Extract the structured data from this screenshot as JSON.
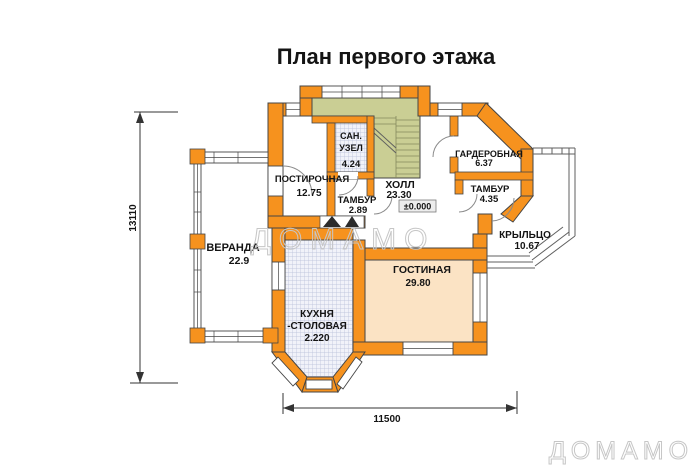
{
  "title": "План первого этажа",
  "watermark": {
    "text": "ДОМАМО"
  },
  "rooms": {
    "postirochnaya": {
      "name": "ПОСТИРОЧНАЯ",
      "area": "12.75"
    },
    "san_uzel": {
      "name_line1": "САН.",
      "name_line2": "УЗЕЛ",
      "area": "4.24"
    },
    "tambur1": {
      "name": "ТАМБУР",
      "area": "2.89"
    },
    "hall": {
      "name": "ХОЛЛ",
      "area": "23.30",
      "level_mark": "±0.000"
    },
    "garderobnaya": {
      "name": "ГАРДЕРОБНАЯ",
      "area": "6.37"
    },
    "tambur2": {
      "name": "ТАМБУР",
      "area": "4.35"
    },
    "kryltso": {
      "name": "КРЫЛЬЦО",
      "area": "10.67"
    },
    "veranda": {
      "name": "ВЕРАНДА",
      "area": "22.9"
    },
    "gostinaya": {
      "name": "ГОСТИНАЯ",
      "area": "29.80"
    },
    "kuhnya_stolovaya": {
      "name_line1": "КУХНЯ",
      "name_line2": "-СТОЛОВАЯ",
      "area": "2.220"
    }
  },
  "dimensions": {
    "left": "13110",
    "bottom": "11500"
  },
  "colors": {
    "wall": "#f6921e",
    "stairs": "#cace94",
    "living_floor": "#fbe3c4",
    "hatch_bg": "#f1f2f9",
    "watermark": "#c6c6c6"
  }
}
